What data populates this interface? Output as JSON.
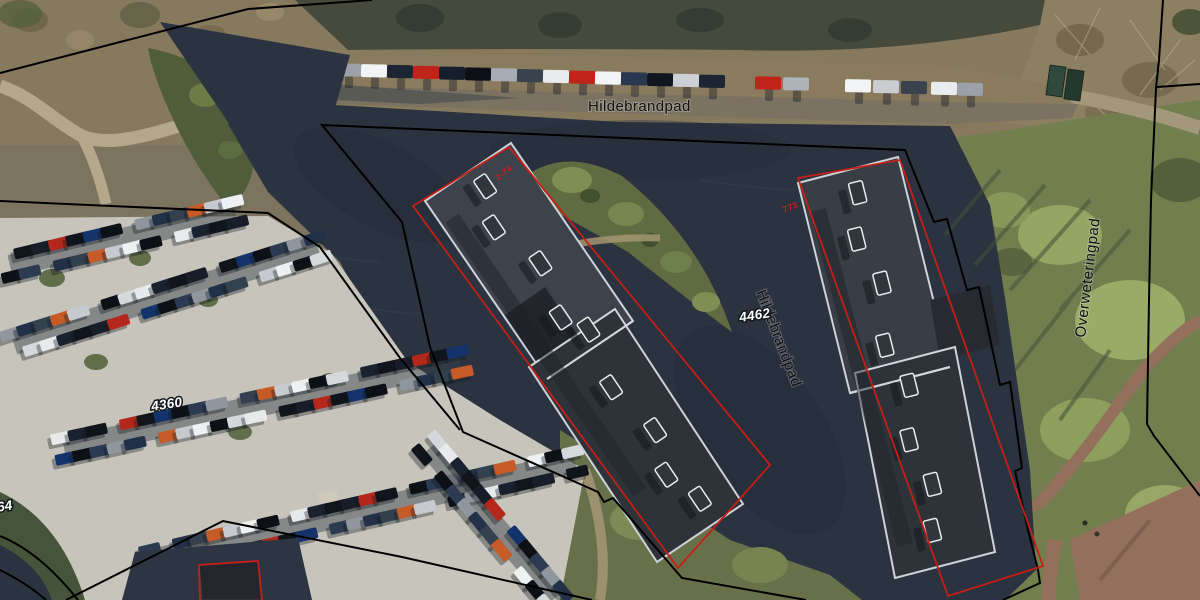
{
  "map": {
    "description": "Aerial photograph with cadastral parcel overlay",
    "labels": {
      "street_top": "Hildebrandpad",
      "street_center": "Hildebrandpad",
      "street_right": "Overweteringpad"
    },
    "parcels": {
      "parking_lot": "4360",
      "center": "4462",
      "left_edge": "364"
    },
    "annotations": {
      "left_building": "2-74",
      "right_building": "773"
    },
    "colors": {
      "boundary_line": "#000000",
      "building_outline": "#c51f16",
      "annotation_text": "#c51f16",
      "street_text": "#111111",
      "parcel_text": "#ffffff",
      "shadow_area": "#2b3340",
      "parking_surface": "#c7c4bc",
      "roof_dark": "#2e333a",
      "grass": "#68704a",
      "brick_path": "#94705c"
    }
  }
}
